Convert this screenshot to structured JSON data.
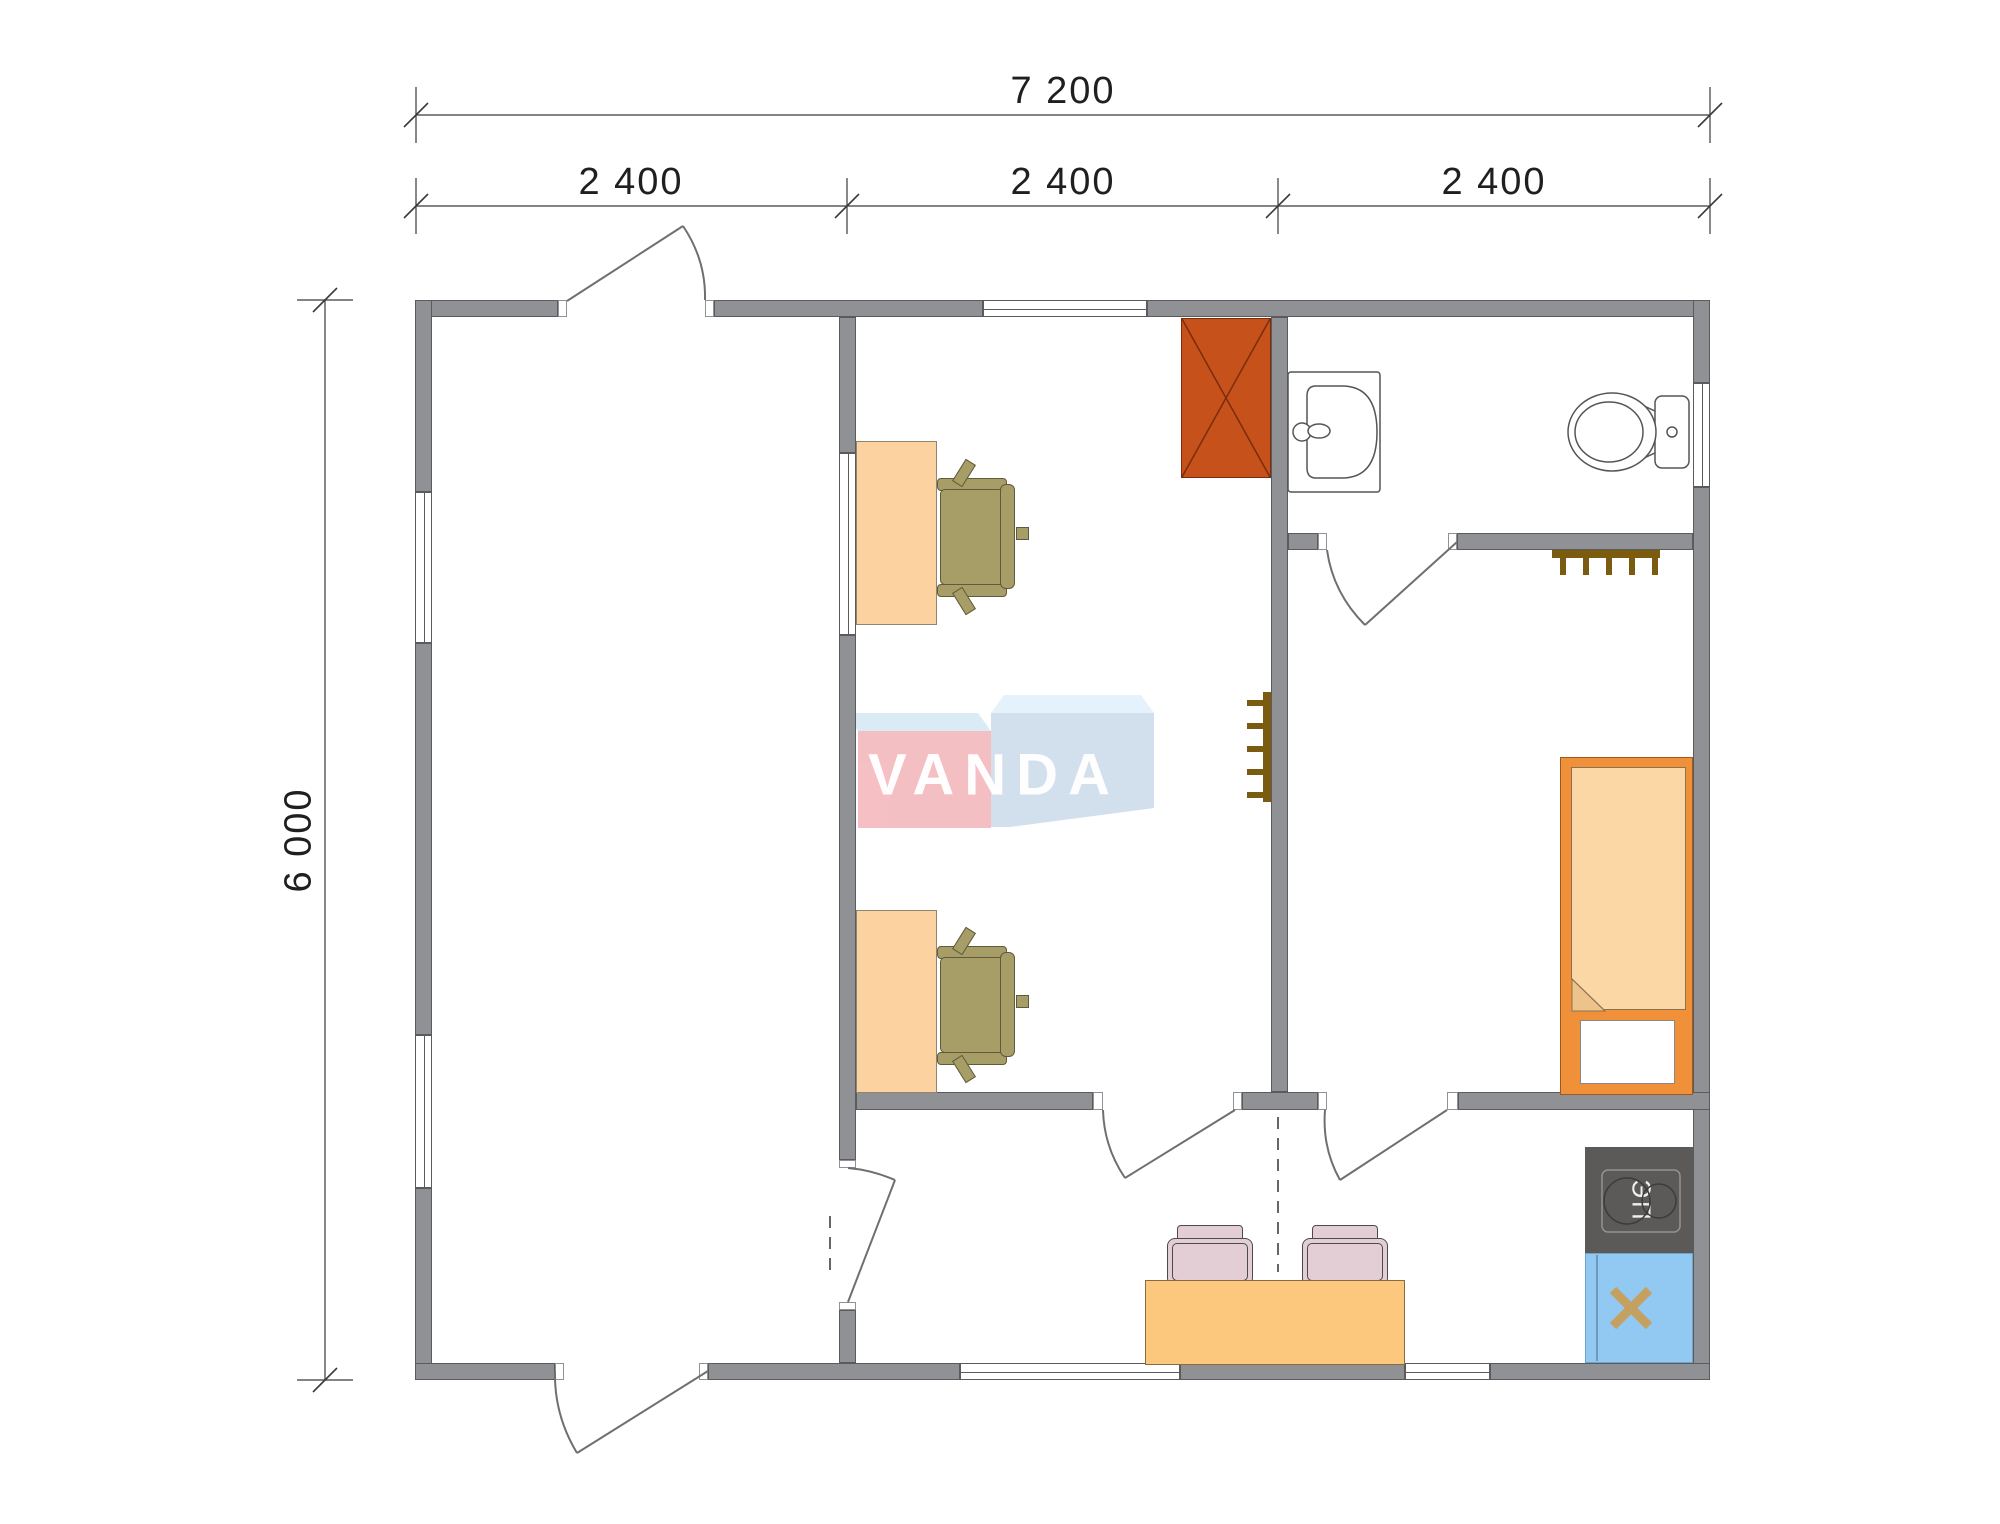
{
  "drawing": {
    "type": "floor-plan",
    "dimensions": {
      "total_width": "7 200",
      "segments": [
        "2 400",
        "2 400",
        "2 400"
      ],
      "height": "6 000"
    },
    "watermark": {
      "text": "VANDA"
    },
    "kitchen": {
      "stove_label": "ЭП"
    },
    "fixtures": [
      "wardrobe",
      "desk",
      "office-chair",
      "washbasin",
      "toilet",
      "radiator",
      "bed",
      "dining-table",
      "dining-chair",
      "electric-stove",
      "kitchen-sink"
    ],
    "colors": {
      "wall_fill": "#8F9194",
      "wall_outline": "#5A5B5D",
      "furniture_tan": "#FCD3A0",
      "table_orange": "#FBC87E",
      "bed_frame": "#F0913A",
      "bed_mattress": "#FBD7A6",
      "wardrobe_red": "#C6511B",
      "office_chair_olive": "#A79D66",
      "dining_chair_pink": "#E3CED6",
      "stove_dark": "#5B5A58",
      "sink_blue": "#92C9F3",
      "radiator_brown": "#7B5B10",
      "logo_pink": "#F4BABE",
      "logo_blue": "#CFDEED",
      "dimension_text": "#1F1F1F"
    }
  }
}
